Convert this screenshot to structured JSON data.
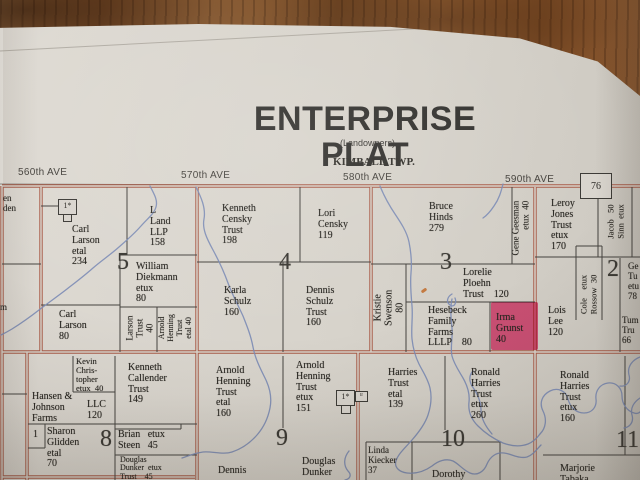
{
  "map": {
    "title": "ENTERPRISE PLAT",
    "subtitle": "(Landowners)",
    "township": "KIMBALL TWP.",
    "page_number": "76",
    "avenues": [
      "560th AVE",
      "570th AVE",
      "580th AVE",
      "590th AVE"
    ],
    "section_numbers": [
      "5",
      "4",
      "3",
      "2",
      "8",
      "9",
      "10",
      "11"
    ],
    "symbols": {
      "farmstead_a": "1*",
      "farmstead_b": "1*",
      "farmstead_b_tag": "tr",
      "lot_number": "1"
    },
    "colors": {
      "road": "#a85a47",
      "parcel_line": "#44423e",
      "stream": "#7b8bb5",
      "highlight": "#f23e7c",
      "paper": "#d9d5ce",
      "wood": "#7d4e28"
    },
    "parcels": [
      {
        "label": "en\nden"
      },
      {
        "label": "Carl\nLarson\netal\n234"
      },
      {
        "label": "L\nLand\nLLP\n158"
      },
      {
        "label": "William\nDiekmann\netux\n80"
      },
      {
        "label": "Carl\nLarson\n80"
      },
      {
        "label": "Larson\nTrust\n40"
      },
      {
        "label": "Arnold\nHenning\nTrust\netal 40"
      },
      {
        "label": "m"
      },
      {
        "label": "Kenneth\nCensky\nTrust\n198"
      },
      {
        "label": "Lori\nCensky\n119"
      },
      {
        "label": "Karla\nSchulz\n160"
      },
      {
        "label": "Dennis\nSchulz\nTrust\n160"
      },
      {
        "label": "Bruce\nHinds\n279"
      },
      {
        "label": "Gene Geesman\netux  40"
      },
      {
        "label": "Kristie\nSwenson\n80"
      },
      {
        "label": "Lorelie\nPloehn\nTrust    120"
      },
      {
        "label": "Hesebeck\nFamily\nFarms\nLLLP    80"
      },
      {
        "label": "Irma\nGrunst\n40"
      },
      {
        "label": "Leroy\nJones\nTrust\netux\n170"
      },
      {
        "label": "Jacob   50\nSinn  etux"
      },
      {
        "label": "Cole    etux\nRossow  30"
      },
      {
        "label": "Lois\nLee\n120"
      },
      {
        "label": "Ge\nTu\netu\n78"
      },
      {
        "label": "Tum\nTru\n66"
      },
      {
        "label": "Kevin\nChris-\ntopher\netux  40"
      },
      {
        "label": "Hansen &\nJohnson\nFarms"
      },
      {
        "label": "LLC\n120"
      },
      {
        "label": "Kenneth\nCallender\nTrust\n149"
      },
      {
        "label": "Sharon\nGlidden\netal\n70"
      },
      {
        "label": "1"
      },
      {
        "label": "Brian   etux\nSteen   45"
      },
      {
        "label": "Douglas\nDunker  etux\nTrust    45"
      },
      {
        "label": "Arnold\nHenning\nTrust\netal\n160"
      },
      {
        "label": "Arnold\nHenning\nTrust\netux\n151"
      },
      {
        "label": "Dennis"
      },
      {
        "label": "Douglas\nDunker"
      },
      {
        "label": "Harries\nTrust\netal\n139"
      },
      {
        "label": "Ronald\nHarries\nTrust\netux\n260"
      },
      {
        "label": "Linda\nKiecker\n37"
      },
      {
        "label": "Dorothy"
      },
      {
        "label": "Ronald\nHarries\nTrust\netux\n160"
      },
      {
        "label": "Marjorie\nTabaka"
      }
    ]
  }
}
